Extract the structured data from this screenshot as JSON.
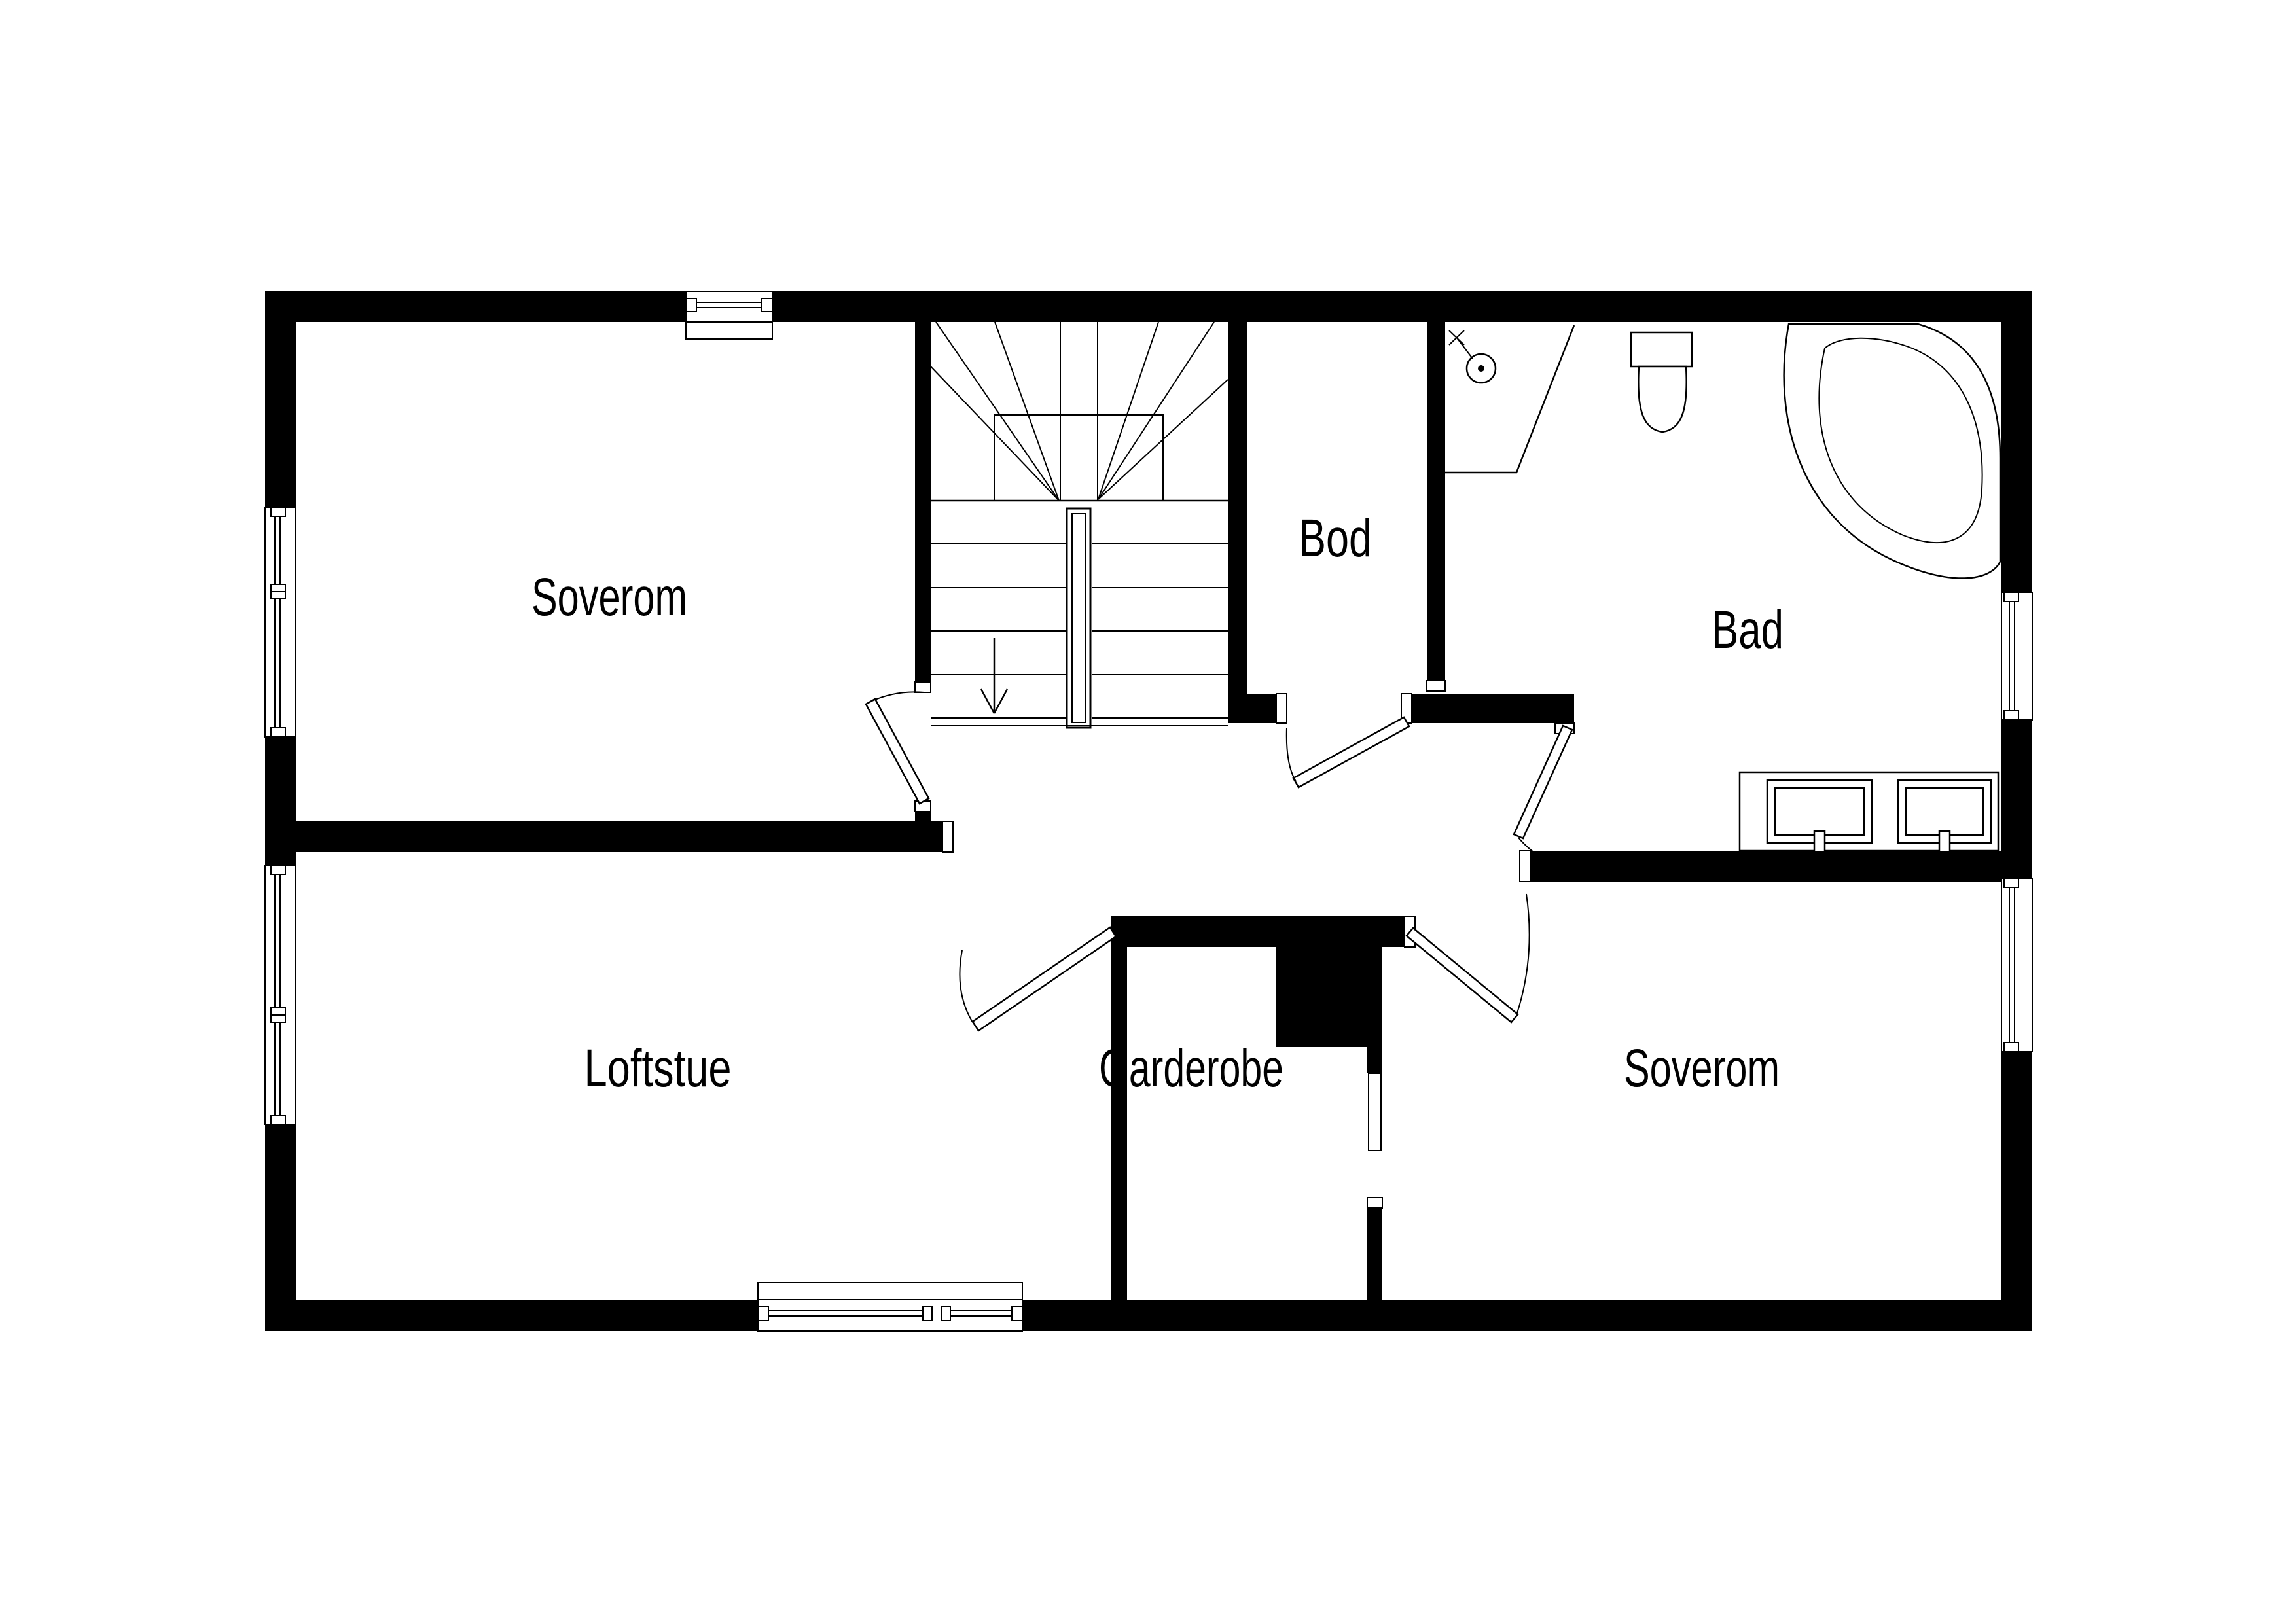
{
  "title": "Loft floor plan",
  "colors": {
    "background": "#ffffff",
    "walls": "#000000",
    "lines": "#000000",
    "text": "#000000"
  },
  "rooms": [
    {
      "id": "soverom-top",
      "label": "Soverom"
    },
    {
      "id": "bod",
      "label": "Bod"
    },
    {
      "id": "bad",
      "label": "Bad"
    },
    {
      "id": "loftstue",
      "label": "Loftstue"
    },
    {
      "id": "garderobe",
      "label": "Garderobe"
    },
    {
      "id": "soverom-bottom",
      "label": "Soverom"
    }
  ],
  "fixtures": [
    "stairs-with-center-handrail",
    "stair-down-arrow",
    "corner-bathtub",
    "toilet",
    "shower-head",
    "corner-shower-screen",
    "double-sink-vanity",
    "chimney-block",
    "pocket-sliding-door",
    "hinged-door-swings",
    "windows-with-glazing"
  ]
}
